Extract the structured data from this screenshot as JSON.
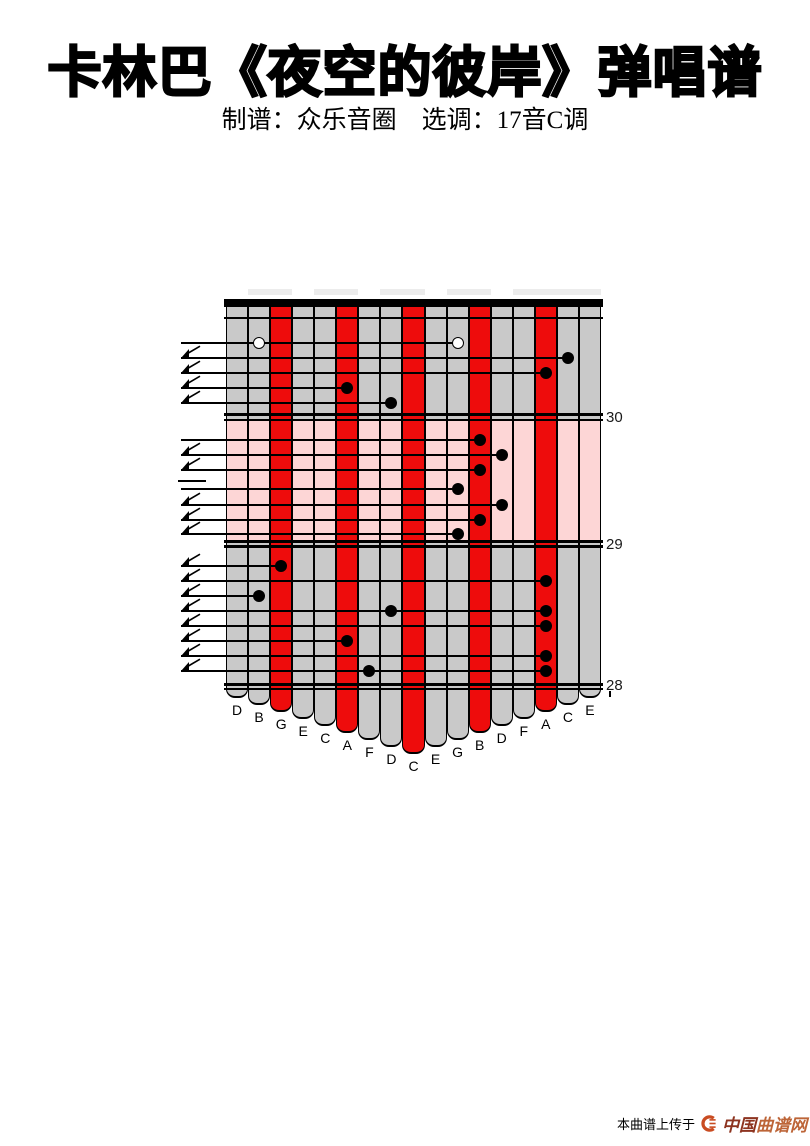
{
  "page": {
    "title": "卡林巴《夜空的彼岸》弹唱谱",
    "subtitle": "制谱：众乐音圈　选调：17音C调"
  },
  "kalimba": {
    "colors": {
      "red": "#ee0c0c",
      "gray": "#c9c9c9",
      "pink": "#fdd6d6",
      "line": "#000000"
    },
    "tines": [
      {
        "label": "D",
        "color": "gray"
      },
      {
        "label": "B",
        "color": "gray"
      },
      {
        "label": "G",
        "color": "red"
      },
      {
        "label": "E",
        "color": "gray"
      },
      {
        "label": "C",
        "color": "gray"
      },
      {
        "label": "A",
        "color": "red"
      },
      {
        "label": "F",
        "color": "gray"
      },
      {
        "label": "D",
        "color": "gray"
      },
      {
        "label": "C",
        "color": "red"
      },
      {
        "label": "E",
        "color": "gray"
      },
      {
        "label": "G",
        "color": "gray"
      },
      {
        "label": "B",
        "color": "red"
      },
      {
        "label": "D",
        "color": "gray"
      },
      {
        "label": "F",
        "color": "gray"
      },
      {
        "label": "A",
        "color": "red"
      },
      {
        "label": "C",
        "color": "gray"
      },
      {
        "label": "E",
        "color": "gray"
      }
    ],
    "measures": [
      {
        "number": "30",
        "background": "gray",
        "rows": [
          {
            "flag": false,
            "notes": [
              {
                "tine": 1,
                "hollow": true
              },
              {
                "tine": 10,
                "hollow": true
              }
            ]
          },
          {
            "flag": true,
            "notes": [
              {
                "tine": 15,
                "hollow": false
              }
            ]
          },
          {
            "flag": true,
            "notes": [
              {
                "tine": 14,
                "hollow": false
              }
            ]
          },
          {
            "flag": true,
            "notes": [
              {
                "tine": 5,
                "hollow": false
              }
            ]
          },
          {
            "flag": true,
            "notes": [
              {
                "tine": 7,
                "hollow": false
              }
            ]
          }
        ]
      },
      {
        "number": "29",
        "background": "pink",
        "rows": [
          {
            "flag": false,
            "notes": [
              {
                "tine": 11,
                "hollow": false
              }
            ]
          },
          {
            "flag": true,
            "notes": [
              {
                "tine": 12,
                "hollow": false
              }
            ]
          },
          {
            "flag": true,
            "notes": [
              {
                "tine": 11,
                "hollow": false
              }
            ]
          },
          {
            "dash": true,
            "notes": []
          },
          {
            "flag": false,
            "notes": [
              {
                "tine": 10,
                "hollow": false
              }
            ]
          },
          {
            "flag": true,
            "notes": [
              {
                "tine": 12,
                "hollow": false
              }
            ]
          },
          {
            "flag": true,
            "notes": [
              {
                "tine": 11,
                "hollow": false
              }
            ]
          },
          {
            "flag": true,
            "notes": [
              {
                "tine": 10,
                "hollow": false
              }
            ]
          }
        ]
      },
      {
        "number": "28",
        "background": "gray",
        "rows": [
          {
            "flag": true,
            "notes": [
              {
                "tine": 2,
                "hollow": false
              }
            ]
          },
          {
            "flag": true,
            "notes": [
              {
                "tine": 14,
                "hollow": false
              }
            ]
          },
          {
            "flag": true,
            "notes": [
              {
                "tine": 1,
                "hollow": false
              }
            ]
          },
          {
            "flag": true,
            "notes": [
              {
                "tine": 7,
                "hollow": false
              },
              {
                "tine": 14,
                "hollow": false
              }
            ]
          },
          {
            "flag": true,
            "notes": [
              {
                "tine": 14,
                "hollow": false
              }
            ]
          },
          {
            "flag": true,
            "notes": [
              {
                "tine": 5,
                "hollow": false
              }
            ]
          },
          {
            "flag": true,
            "notes": [
              {
                "tine": 14,
                "hollow": false
              }
            ]
          },
          {
            "flag": true,
            "notes": [
              {
                "tine": 6,
                "hollow": false
              },
              {
                "tine": 14,
                "hollow": false
              }
            ]
          }
        ]
      }
    ]
  },
  "watermark": {
    "prefix": "本曲谱上传于",
    "site": "中国曲谱网",
    "site_part1": "中国",
    "site_part2": "曲谱网"
  }
}
